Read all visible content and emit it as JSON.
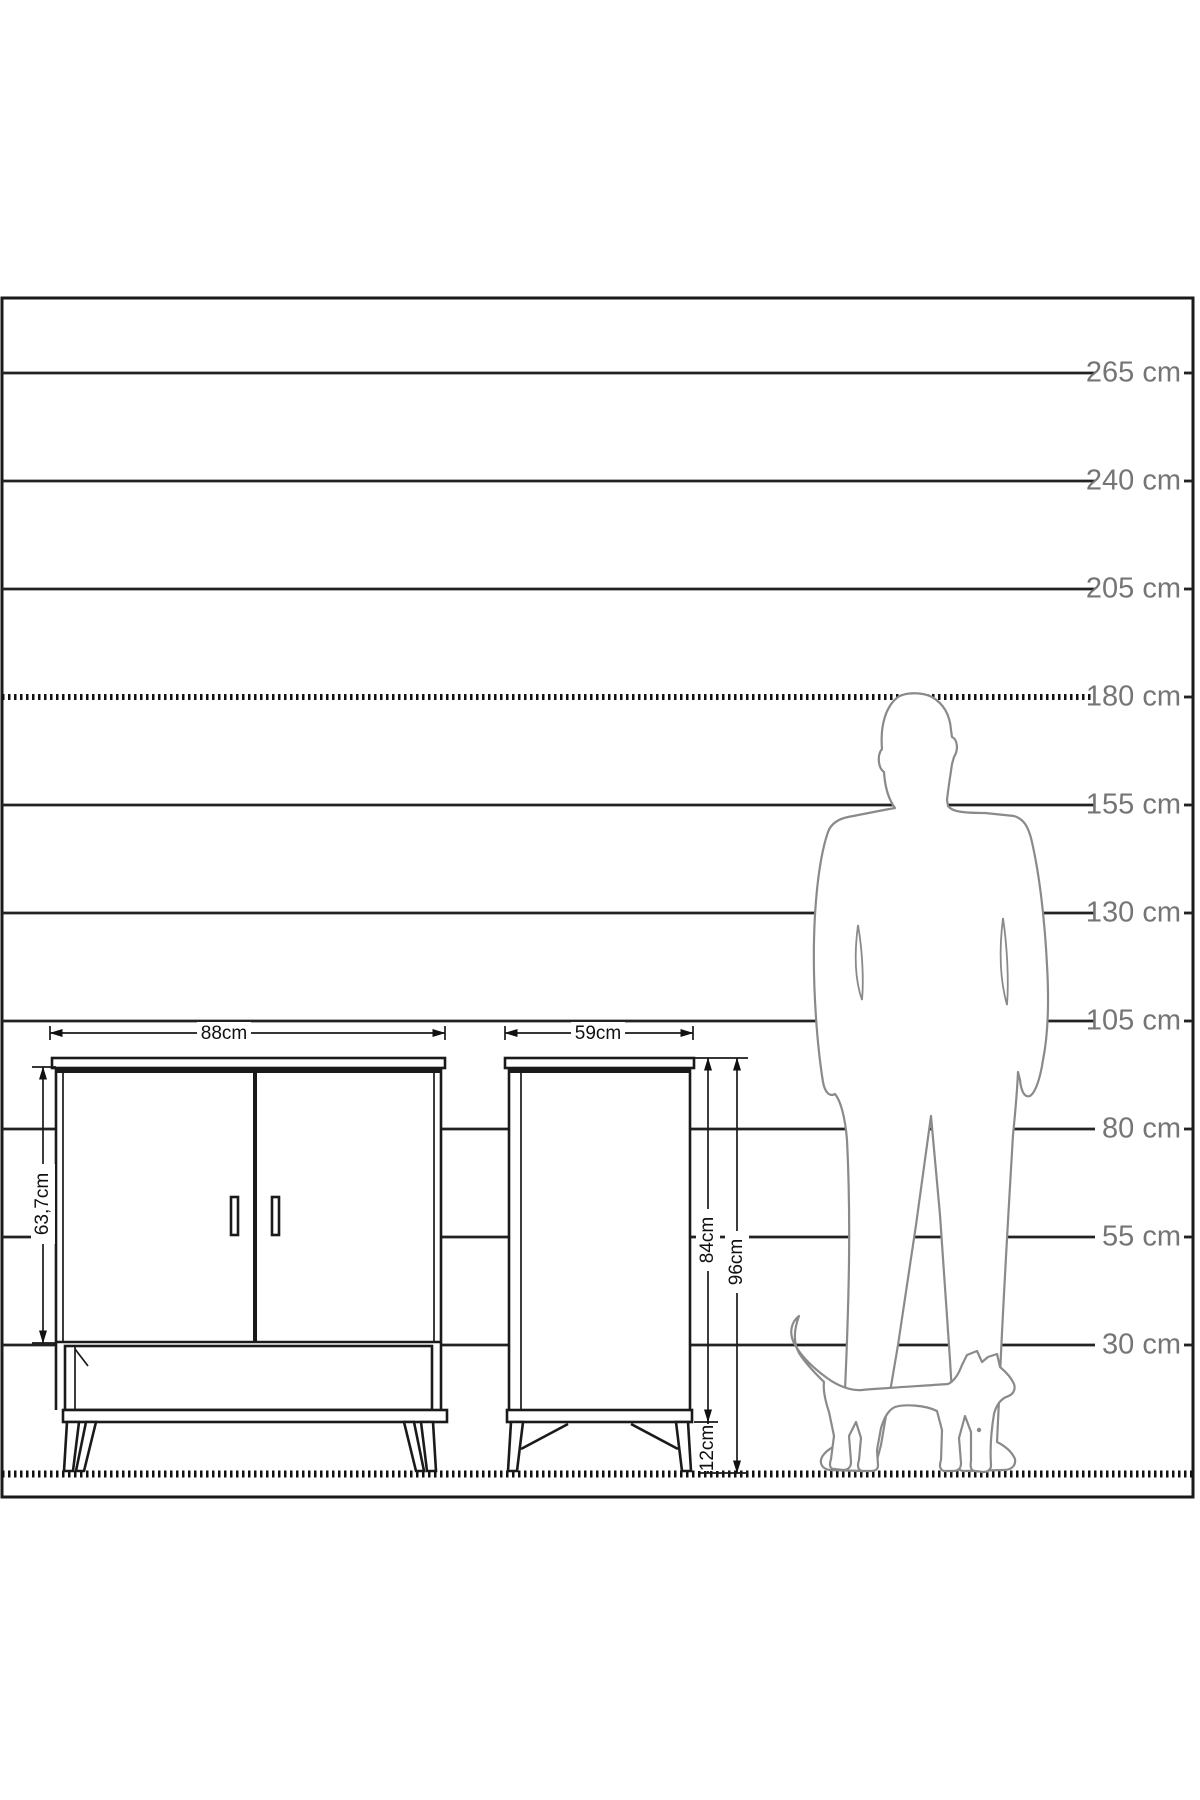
{
  "scale": {
    "unit": "cm",
    "rows": [
      {
        "label": "265 cm",
        "value_cm": 265
      },
      {
        "label": "240 cm",
        "value_cm": 240
      },
      {
        "label": "205 cm",
        "value_cm": 205
      },
      {
        "label": "180 cm",
        "value_cm": 180
      },
      {
        "label": "155 cm",
        "value_cm": 155
      },
      {
        "label": "130 cm",
        "value_cm": 130
      },
      {
        "label": "105 cm",
        "value_cm": 105
      },
      {
        "label": "80 cm",
        "value_cm": 80
      },
      {
        "label": "55 cm",
        "value_cm": 55
      },
      {
        "label": "30 cm",
        "value_cm": 30
      }
    ]
  },
  "furniture": {
    "front_view": {
      "width_label": "88cm",
      "door_height_label": "63,7cm"
    },
    "side_view": {
      "depth_label": "59cm",
      "body_height_label": "84cm",
      "total_height_label": "96cm",
      "leg_height_label": "12cm"
    }
  },
  "figures": {
    "person": "man-silhouette",
    "cat": "cat-silhouette"
  },
  "colors": {
    "outline": "#1a1a1a",
    "scale_label_gray": "#757575",
    "silhouette_gray": "#8a8a8a",
    "background": "#ffffff"
  }
}
